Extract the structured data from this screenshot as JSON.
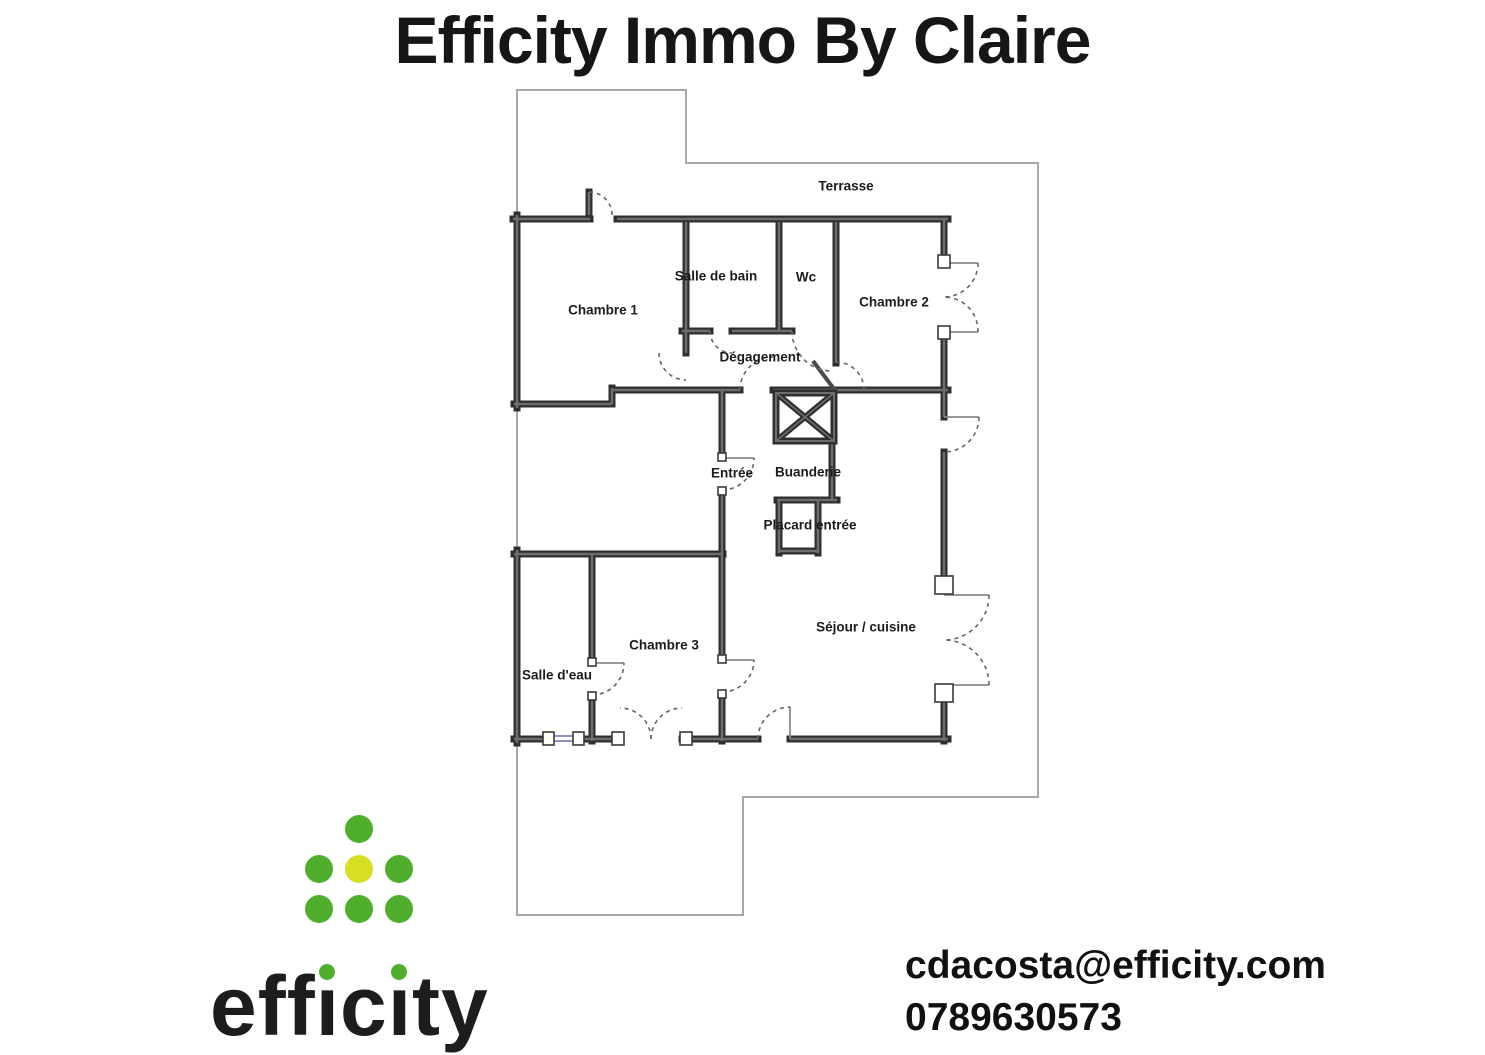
{
  "title": "Efficity Immo By Claire",
  "floorplan": {
    "rooms": [
      {
        "label": "Terrasse"
      },
      {
        "label": "Chambre 1"
      },
      {
        "label": "Salle de bain"
      },
      {
        "label": "Wc"
      },
      {
        "label": "Chambre 2"
      },
      {
        "label": "Dégagement"
      },
      {
        "label": "Entrée"
      },
      {
        "label": "Buanderie"
      },
      {
        "label": "Placard entrée"
      },
      {
        "label": "Chambre 3"
      },
      {
        "label": "Salle d'eau"
      },
      {
        "label": "Séjour / cuisine"
      }
    ],
    "colors": {
      "wall": "#2f2f2f",
      "wall_core": "#6e6e6e",
      "boundary": "#a8a8a8",
      "door_arc": "#666666",
      "window_glass": "#8080c0"
    }
  },
  "logo": {
    "brand": "efficity",
    "colors": {
      "green": "#4FAE2C",
      "yellow": "#D7DF23",
      "text": "#1D1D1B"
    }
  },
  "contact": {
    "email": "cdacosta@efficity.com",
    "phone": "0789630573"
  }
}
